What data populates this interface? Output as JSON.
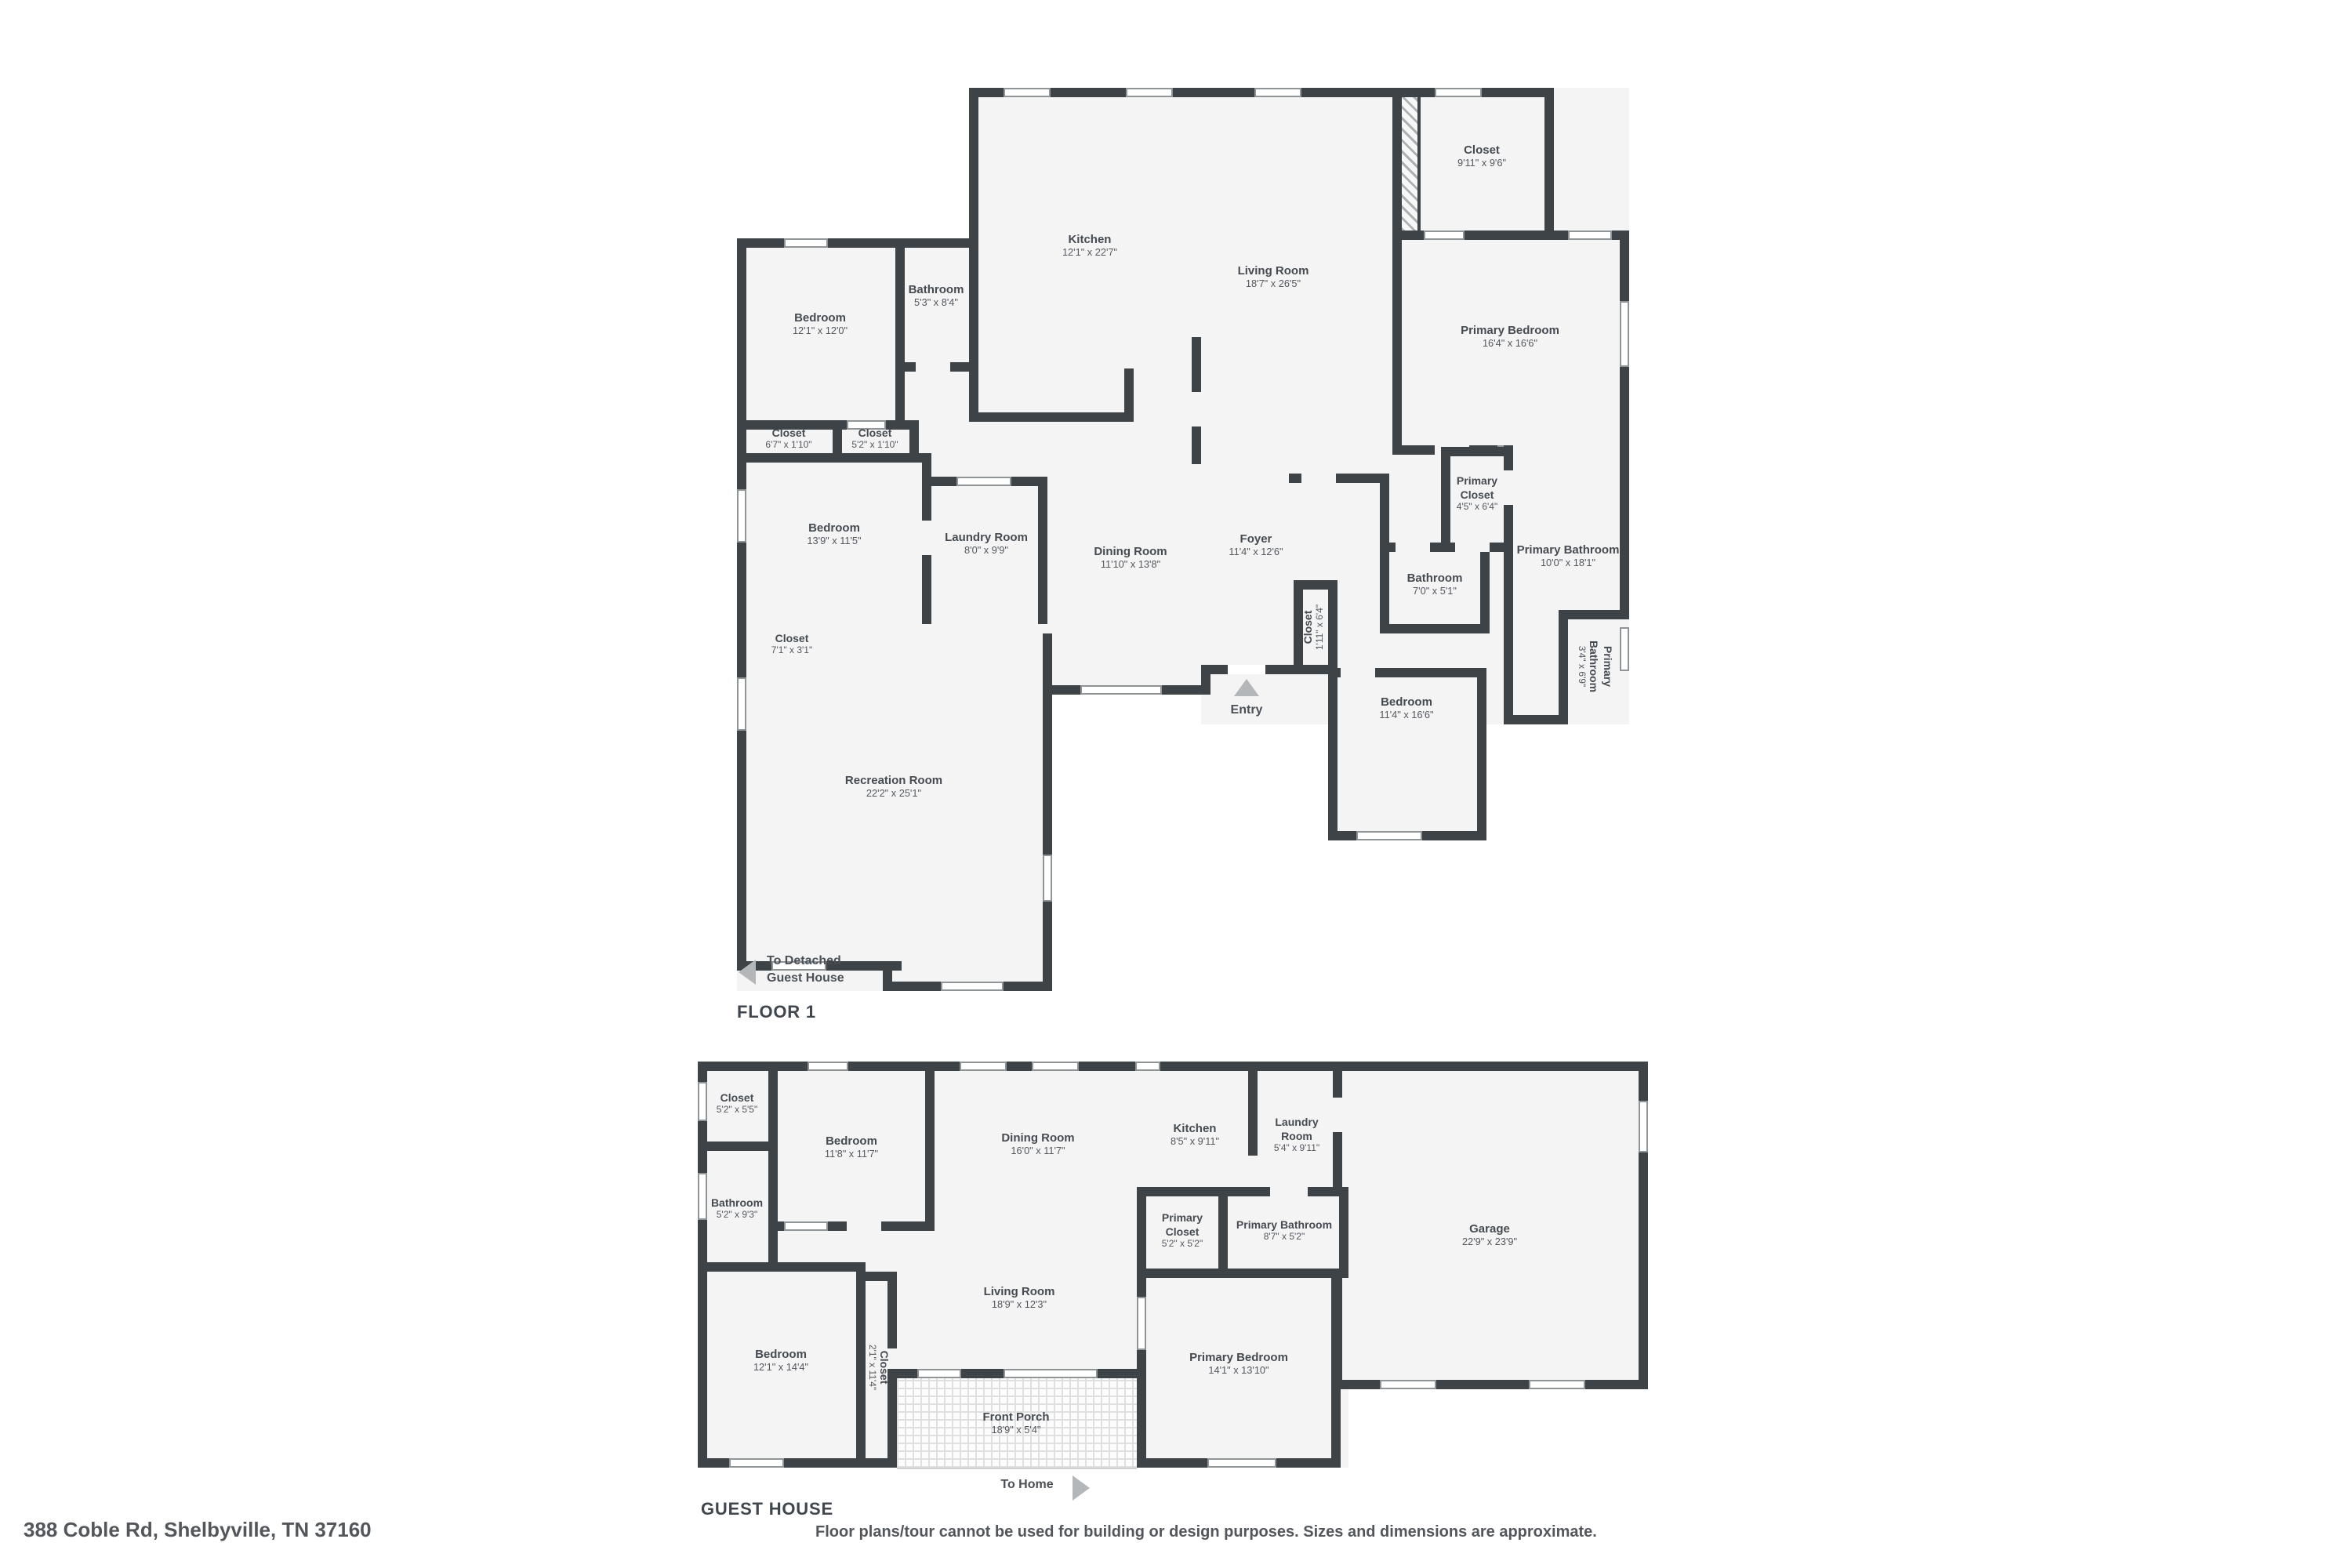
{
  "page": {
    "background": "#ffffff",
    "wall_color": "#3e4347",
    "floor_color": "#f4f4f5",
    "label_color": "#454b51",
    "arrow_color": "#b4b7ba"
  },
  "floor1": {
    "title": "FLOOR 1",
    "entry_label": "Entry",
    "exit_note_line1": "To Detached",
    "exit_note_line2": "Guest House",
    "rooms": [
      {
        "name": "Kitchen",
        "dims": "12'1\" x 22'7\""
      },
      {
        "name": "Living Room",
        "dims": "18'7\" x 26'5\""
      },
      {
        "name": "Closet",
        "dims": "9'11\" x 9'6\""
      },
      {
        "name": "Primary Bedroom",
        "dims": "16'4\" x 16'6\""
      },
      {
        "name": "Bedroom",
        "dims": "12'1\" x 12'0\""
      },
      {
        "name": "Bathroom",
        "dims": "5'3\" x 8'4\""
      },
      {
        "name": "Closet",
        "dims": "6'7\" x 1'10\""
      },
      {
        "name": "Closet",
        "dims": "5'2\" x 1'10\""
      },
      {
        "name": "Bedroom",
        "dims": "13'9\" x 11'5\""
      },
      {
        "name": "Laundry Room",
        "dims": "8'0\" x 9'9\""
      },
      {
        "name": "Dining Room",
        "dims": "11'10\" x 13'8\""
      },
      {
        "name": "Foyer",
        "dims": "11'4\" x 12'6\""
      },
      {
        "name": "Closet",
        "dims": "1'11\" x 6'4\""
      },
      {
        "name": "Bathroom",
        "dims": "7'0\" x 5'1\""
      },
      {
        "name": "Primary Closet",
        "dims": "4'5\" x 6'4\""
      },
      {
        "name": "Primary Bathroom",
        "dims": "10'0\" x 18'1\""
      },
      {
        "name": "Primary Bathroom",
        "dims": "3'4\" x 6'9\""
      },
      {
        "name": "Bedroom",
        "dims": "11'4\" x 16'6\""
      },
      {
        "name": "Closet",
        "dims": "7'1\" x 3'1\""
      },
      {
        "name": "Recreation Room",
        "dims": "22'2\" x 25'1\""
      }
    ]
  },
  "guest_house": {
    "title": "GUEST HOUSE",
    "to_home_label": "To Home",
    "rooms": [
      {
        "name": "Closet",
        "dims": "5'2\" x 5'5\""
      },
      {
        "name": "Bedroom",
        "dims": "11'8\" x 11'7\""
      },
      {
        "name": "Dining Room",
        "dims": "16'0\" x 11'7\""
      },
      {
        "name": "Kitchen",
        "dims": "8'5\" x 9'11\""
      },
      {
        "name": "Laundry Room",
        "dims": "5'4\" x 9'11\""
      },
      {
        "name": "Bathroom",
        "dims": "5'2\" x 9'3\""
      },
      {
        "name": "Primary Closet",
        "dims": "5'2\" x 5'2\""
      },
      {
        "name": "Primary Bathroom",
        "dims": "8'7\" x 5'2\""
      },
      {
        "name": "Garage",
        "dims": "22'9\" x 23'9\""
      },
      {
        "name": "Living Room",
        "dims": "18'9\" x 12'3\""
      },
      {
        "name": "Bedroom",
        "dims": "12'1\" x 14'4\""
      },
      {
        "name": "Closet",
        "dims": "2'1\" x 11'4\""
      },
      {
        "name": "Primary Bedroom",
        "dims": "14'1\" x 13'10\""
      },
      {
        "name": "Front Porch",
        "dims": "18'9\" x 5'4\""
      }
    ]
  },
  "footer": {
    "address": "388 Coble Rd, Shelbyville, TN 37160",
    "disclaimer": "Floor plans/tour cannot be used for building or design purposes. Sizes and dimensions are approximate."
  }
}
